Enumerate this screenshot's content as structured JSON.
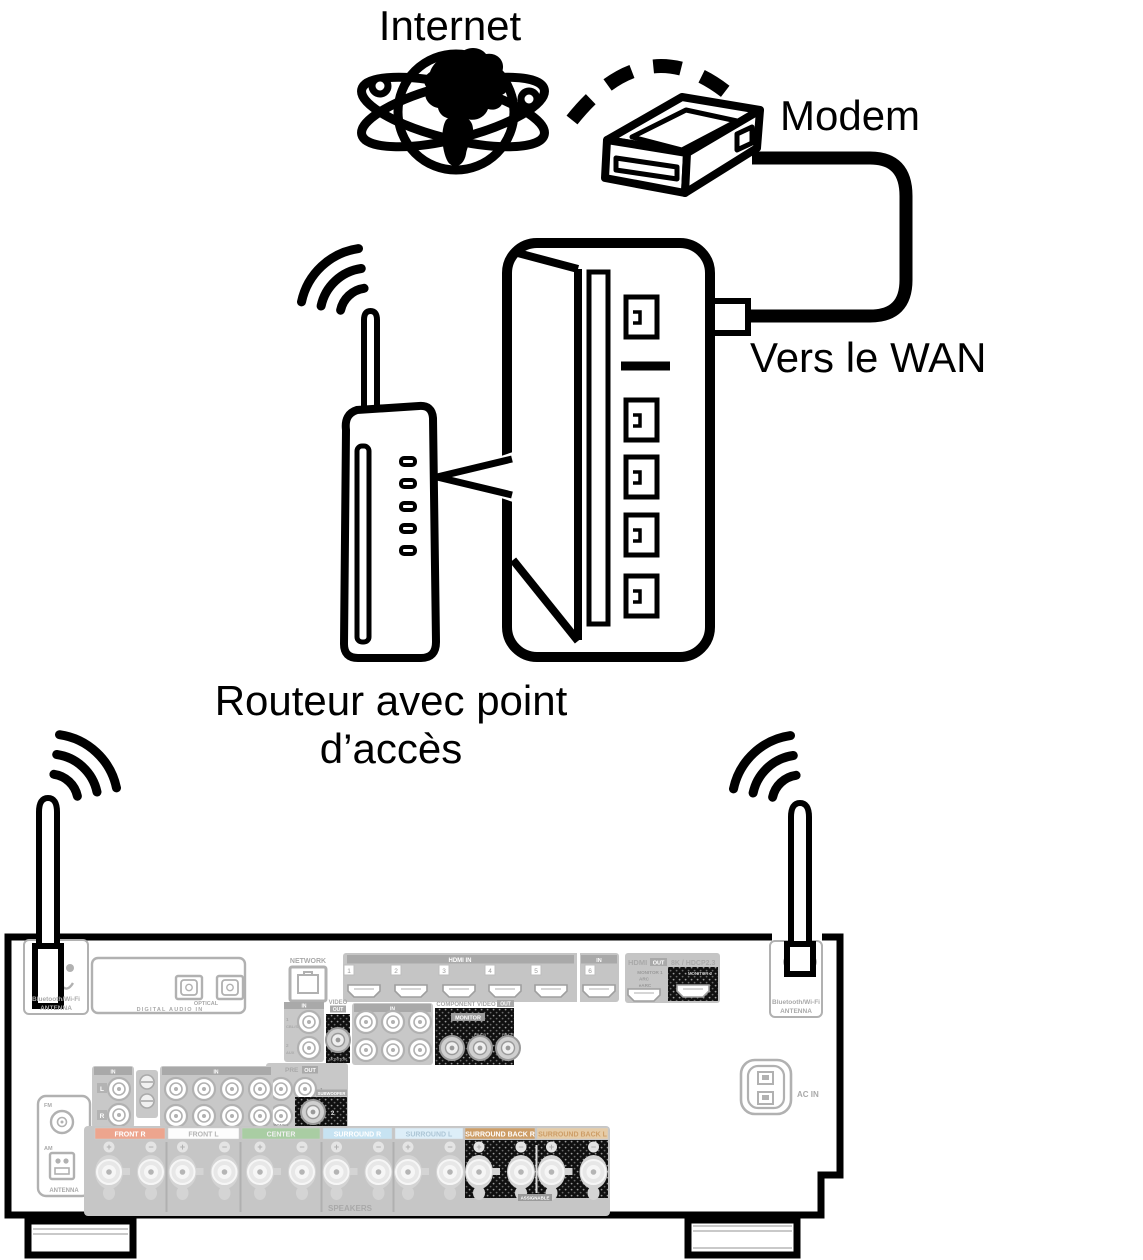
{
  "network_diagram": {
    "internet_label": "Internet",
    "modem_label": "Modem",
    "to_wan_label": "Vers le WAN",
    "router_label_line1": "Routeur avec point",
    "router_label_line2": "d’accès"
  },
  "receiver": {
    "bt_wifi_line1": "Bluetooth/Wi-Fi",
    "bt_wifi_line2": "ANTENNA",
    "network_label": "NETWORK",
    "in_label": "IN",
    "hdmi_in_label": "HDMI IN",
    "optical_label": "OPTICAL",
    "digital_audio_in_label": "DIGITAL AUDIO IN",
    "input1_num": "1",
    "cbl_sat_label": "CBL/SAT",
    "input2_num": "2",
    "aux_label": "AUX",
    "hdmi_ports": [
      "1",
      "2",
      "3",
      "4",
      "5",
      "6"
    ],
    "hdmi_out": {
      "hdmi_label": "HDMI",
      "out_label": "OUT",
      "spec_label": "8K / HDCP2.3",
      "monitor1_label": "MONITOR 1",
      "arc_label": "ARC",
      "earc_label": "eARC",
      "monitor2_label": "MONITOR 2"
    },
    "video_out": {
      "video_label": "VIDEO",
      "out_label": "OUT",
      "monitor_label": "MONITOR"
    },
    "component_video_out": {
      "title_label": "COMPONENT VIDEO",
      "out_label": "OUT",
      "monitor_label": "MONITOR",
      "y_label": "Y",
      "pb_label": "PB/CB",
      "pr_label": "PR/CR"
    },
    "pre_out": {
      "pre_label": "PRE",
      "out_label": "OUT",
      "jack1_label": "1",
      "zone2_label": "ZONE2",
      "subwoofer_label": "SUBWOOFER",
      "jack2_label": "2"
    },
    "tuner": {
      "fm_label": "FM",
      "am_label": "AM",
      "antenna_label": "ANTENNA"
    },
    "ac_in_label": "AC IN",
    "speakers": {
      "title_label": "SPEAKERS",
      "assignable_label": "ASSIGNABLE",
      "plus_label": "+",
      "minus_label": "−",
      "channels": [
        {
          "text": "FRONT R",
          "bg": "#eda58e",
          "fg": "#ffffff"
        },
        {
          "text": "FRONT L",
          "bg": "#fdfdfd",
          "fg": "#b5b5b5"
        },
        {
          "text": "CENTER",
          "bg": "#a9cda3",
          "fg": "#f0f0f0"
        },
        {
          "text": "SURROUND R",
          "bg": "#c7e3f2",
          "fg": "#ffffff"
        },
        {
          "text": "SURROUND L",
          "bg": "#ddeef8",
          "fg": "#adc6d6"
        },
        {
          "text": "SURROUND BACK R",
          "bg": "#cd9d66",
          "fg": "#ffffff"
        },
        {
          "text": "SURROUND BACK L",
          "bg": "#e6cca7",
          "fg": "#cd9d66"
        }
      ]
    }
  },
  "colors": {
    "line_black": "#000000",
    "panel_gray": "#b1b1b1",
    "block_fill_gray": "#c6c6c6",
    "band_gray": "#a9a9a9",
    "highlight_block": "#101010"
  }
}
